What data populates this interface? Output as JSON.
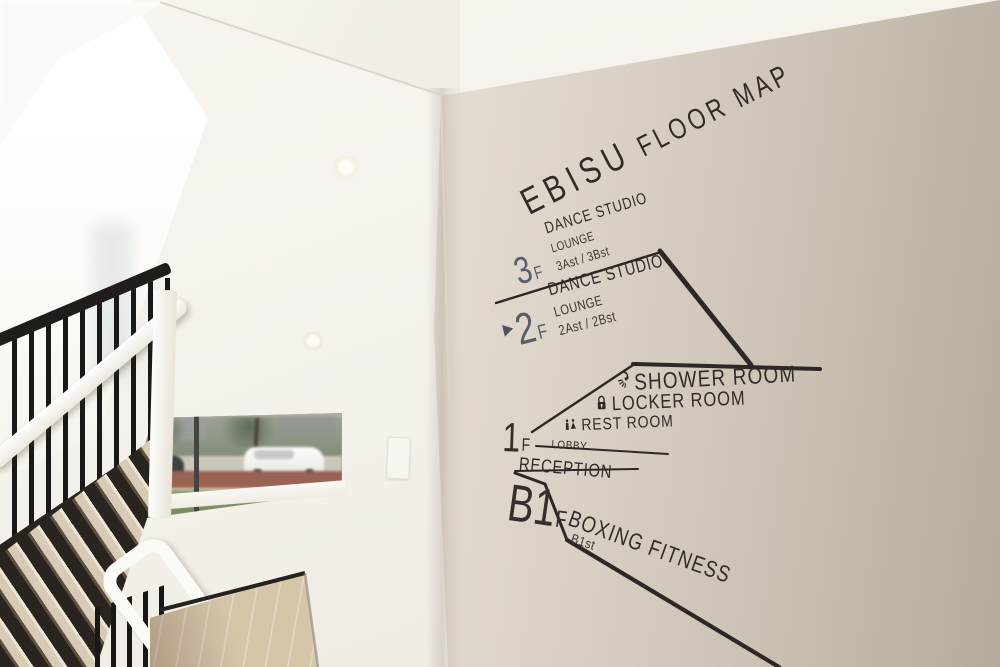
{
  "sign": {
    "title": {
      "brand": "EBISU",
      "label": "FLOOR MAP"
    },
    "floors": {
      "f3": {
        "number": "3",
        "suffix": "F",
        "line1": "DANCE STUDIO",
        "line2": "LOUNGE",
        "line3": "3Ast / 3Bst"
      },
      "f2": {
        "number": "2",
        "suffix": "F",
        "line1": "DANCE STUDIO",
        "line2": "LOUNGE",
        "line3": "2Ast / 2Bst"
      },
      "f1": {
        "number": "1",
        "suffix": "F",
        "line1": "LOBBY",
        "line2": "RECEPTION"
      },
      "b1": {
        "number": "B1",
        "suffix": "F",
        "name": "BOXING FITNESS",
        "sub": "B1st"
      }
    },
    "amenities": {
      "shower": "SHOWER ROOM",
      "locker": "LOCKER ROOM",
      "rest": "REST ROOM"
    },
    "colors": {
      "ink": "#2f2c28",
      "line": "#2b2825",
      "upper_floor_accent": "#585f6b",
      "lower_floor_accent": "#33302b"
    }
  }
}
